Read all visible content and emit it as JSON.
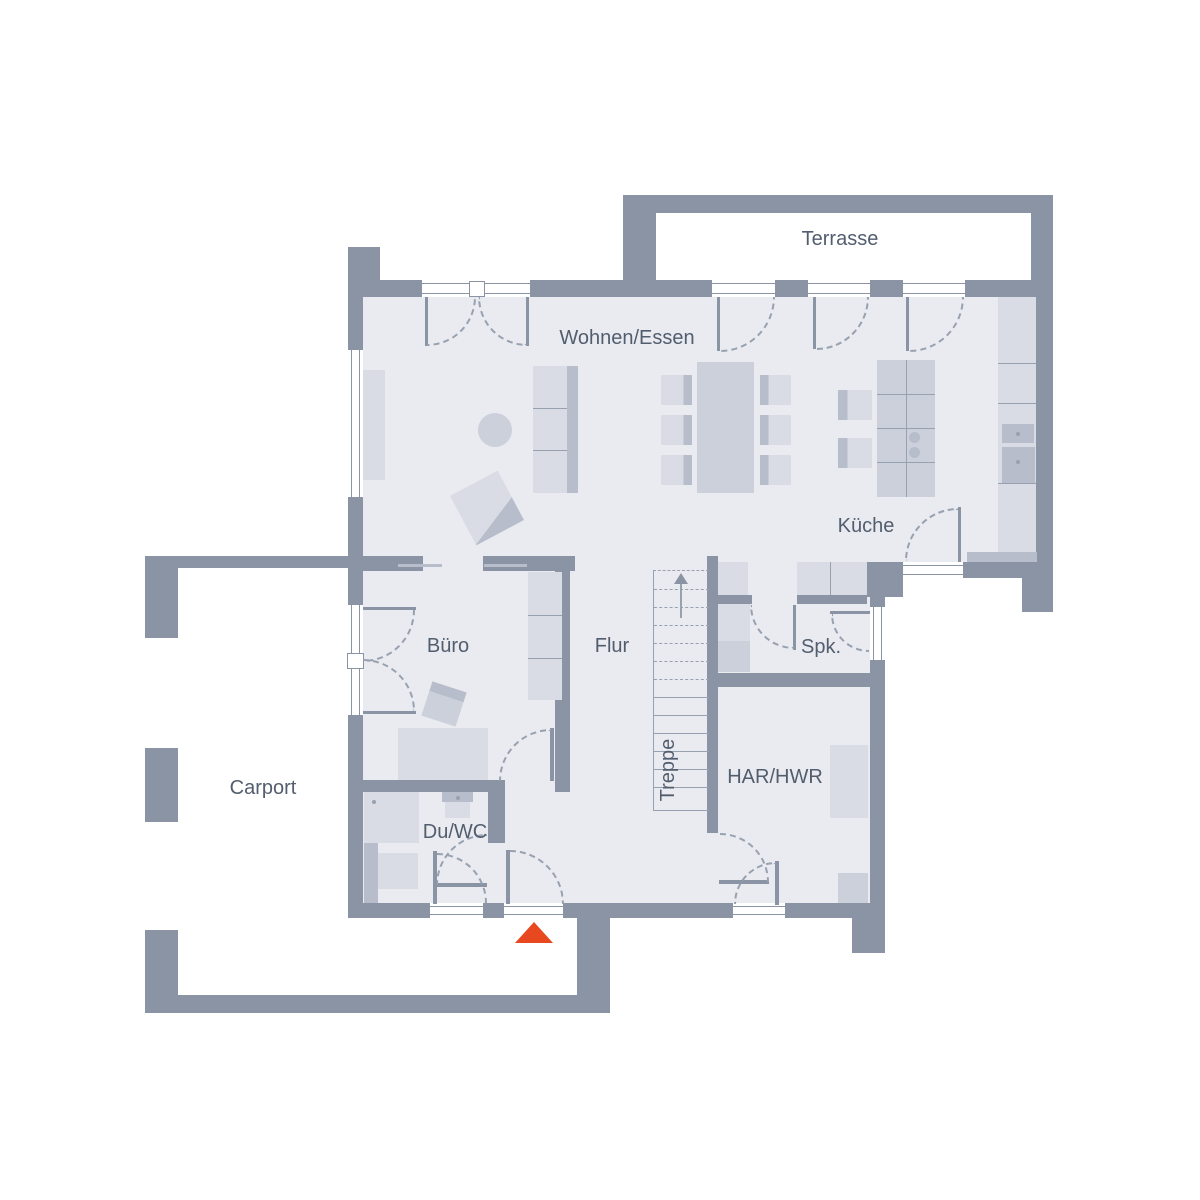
{
  "title": "Erdgeschoss Grundriss",
  "colors": {
    "wall": "#8A94A5",
    "floor": "#E9EBF0",
    "furn": "#D9DCE5",
    "furnmid": "#CBD0DB",
    "furndark": "#B7BDCB",
    "line": "#98A1B0",
    "label": "#525D6E",
    "accent": "#E8481F",
    "bg": "#FFFFFF"
  },
  "rooms": {
    "terrasse": {
      "label": "Terrasse"
    },
    "wohnen_essen": {
      "label": "Wohnen/Essen"
    },
    "kueche": {
      "label": "Küche"
    },
    "buero": {
      "label": "Büro"
    },
    "flur": {
      "label": "Flur"
    },
    "spk": {
      "label": "Spk."
    },
    "treppe": {
      "label": "Treppe"
    },
    "har_hwr": {
      "label": "HAR/HWR"
    },
    "du_wc": {
      "label": "Du/WC"
    },
    "carport": {
      "label": "Carport"
    }
  },
  "entrance_marker": {
    "shape": "triangle-up",
    "color": "#E8481F"
  }
}
